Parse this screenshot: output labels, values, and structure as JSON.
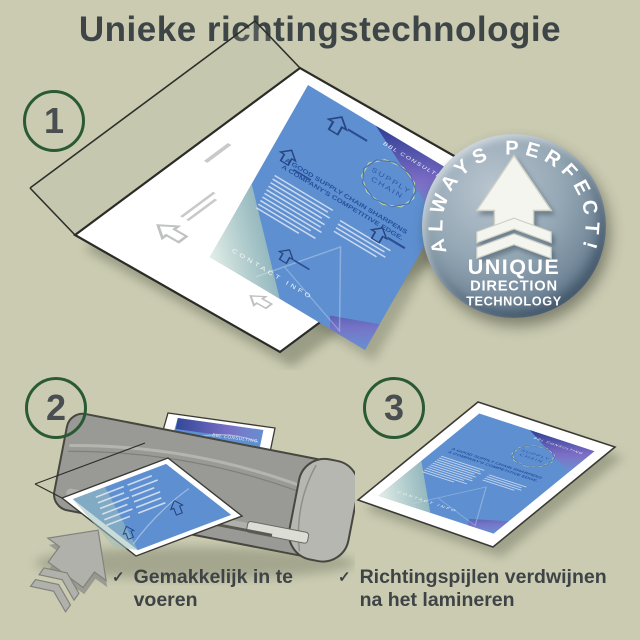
{
  "title": "Unieke richtingstechnologie",
  "steps": [
    {
      "number": "1"
    },
    {
      "number": "2"
    },
    {
      "number": "3"
    }
  ],
  "badge": {
    "arc_text": "ALWAYS PERFECT!",
    "line1": "UNIQUE",
    "line2": "DIRECTION",
    "line3": "TECHNOLOGY"
  },
  "document": {
    "brand": "BBL CONSULTING",
    "logo_line1": "SUPPLY",
    "logo_line2": "CHAIN",
    "headline_line1": "A GOOD SUPPLY CHAIN SHARPENS",
    "headline_line2": "A COMPANY'S COMPETITIVE EDGE.",
    "footer": "CONTACT INFO"
  },
  "checklist": [
    {
      "label": "Gemakkelijk in te voeren"
    },
    {
      "label": "Richtingspijlen verdwijnen na het lamineren"
    }
  ],
  "check_glyph": "✓",
  "colors": {
    "background": "#cacbb1",
    "accent_green": "#2a5a33",
    "text": "#3d4547",
    "doc_blue": "#5e90d1",
    "badge_gray": "#8299a9",
    "laminator_gray": "#9a9b97"
  }
}
